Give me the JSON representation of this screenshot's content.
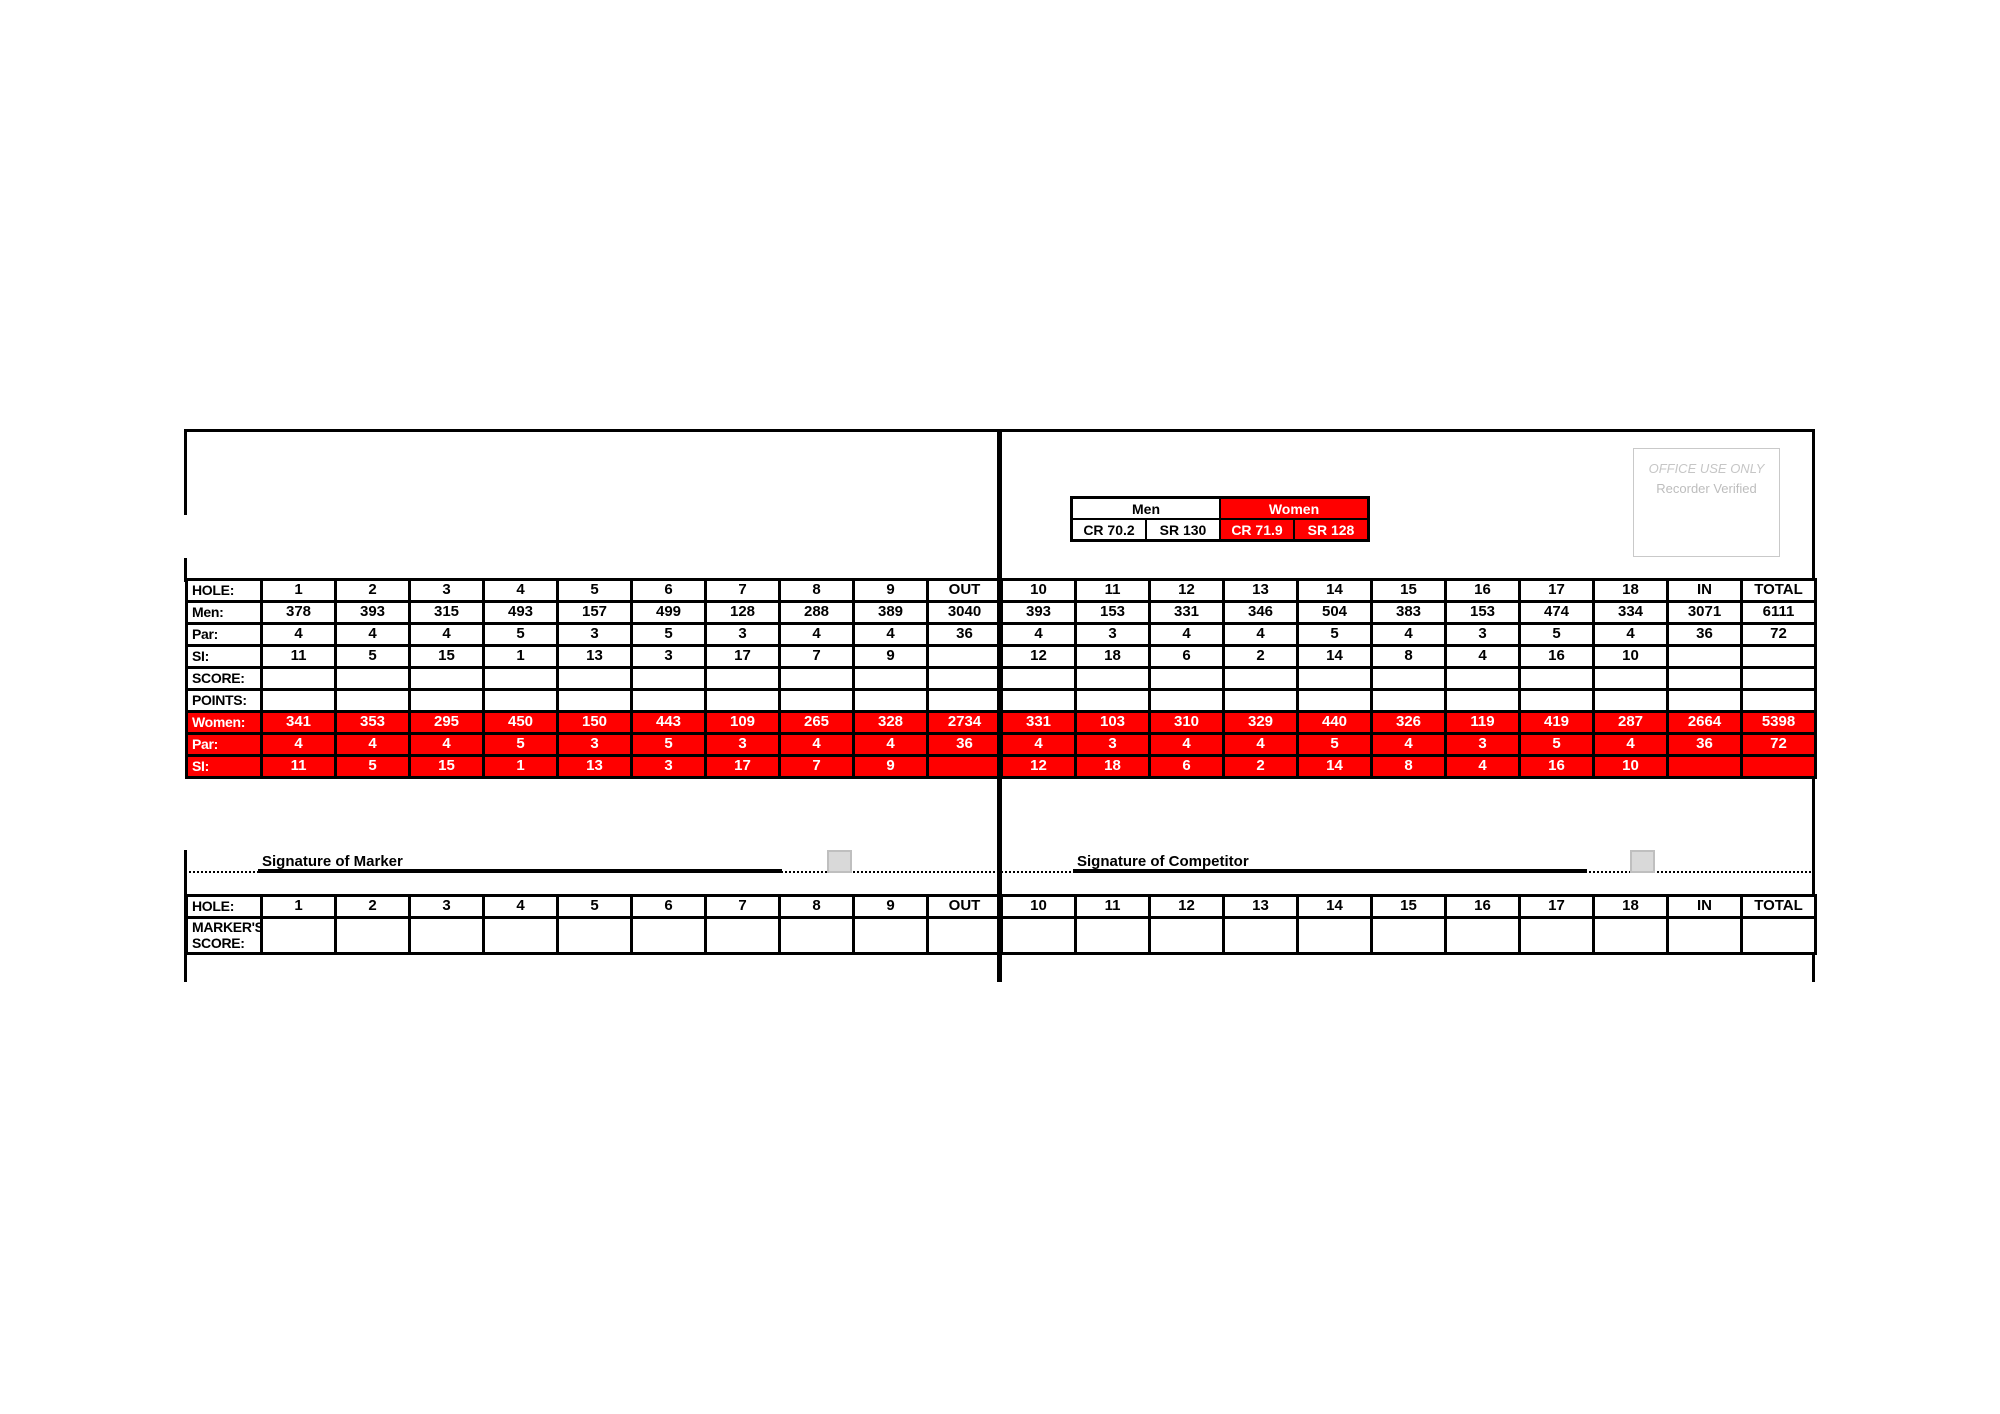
{
  "colors": {
    "accent_red": "#FF0000",
    "border_black": "#000000",
    "checkbox_fill": "#D9D9D9",
    "checkbox_border": "#BFBFBF",
    "office_text_gray": "#C6C6C6"
  },
  "rating_box": {
    "men_label": "Men",
    "women_label": "Women",
    "men_cr": "CR 70.2",
    "men_sr": "SR 130",
    "women_cr": "CR 71.9",
    "women_sr": "SR 128"
  },
  "office_box": {
    "title": "OFFICE USE ONLY",
    "subtitle": "Recorder Verified"
  },
  "course_table": {
    "rows": [
      {
        "label": "HOLE:",
        "variant": "white",
        "cells": [
          "1",
          "2",
          "3",
          "4",
          "5",
          "6",
          "7",
          "8",
          "9",
          "OUT",
          "10",
          "11",
          "12",
          "13",
          "14",
          "15",
          "16",
          "17",
          "18",
          "IN",
          "TOTAL"
        ]
      },
      {
        "label": "Men:",
        "variant": "white",
        "cells": [
          "378",
          "393",
          "315",
          "493",
          "157",
          "499",
          "128",
          "288",
          "389",
          "3040",
          "393",
          "153",
          "331",
          "346",
          "504",
          "383",
          "153",
          "474",
          "334",
          "3071",
          "6111"
        ]
      },
      {
        "label": "Par:",
        "variant": "white",
        "cells": [
          "4",
          "4",
          "4",
          "5",
          "3",
          "5",
          "3",
          "4",
          "4",
          "36",
          "4",
          "3",
          "4",
          "4",
          "5",
          "4",
          "3",
          "5",
          "4",
          "36",
          "72"
        ]
      },
      {
        "label": "SI:",
        "variant": "white",
        "cells": [
          "11",
          "5",
          "15",
          "1",
          "13",
          "3",
          "17",
          "7",
          "9",
          "",
          "12",
          "18",
          "6",
          "2",
          "14",
          "8",
          "4",
          "16",
          "10",
          "",
          ""
        ]
      },
      {
        "label": "SCORE:",
        "variant": "white",
        "cells": [
          "",
          "",
          "",
          "",
          "",
          "",
          "",
          "",
          "",
          "",
          "",
          "",
          "",
          "",
          "",
          "",
          "",
          "",
          "",
          "",
          ""
        ]
      },
      {
        "label": "POINTS:",
        "variant": "white",
        "cells": [
          "",
          "",
          "",
          "",
          "",
          "",
          "",
          "",
          "",
          "",
          "",
          "",
          "",
          "",
          "",
          "",
          "",
          "",
          "",
          "",
          ""
        ]
      },
      {
        "label": "Women:",
        "variant": "red",
        "cells": [
          "341",
          "353",
          "295",
          "450",
          "150",
          "443",
          "109",
          "265",
          "328",
          "2734",
          "331",
          "103",
          "310",
          "329",
          "440",
          "326",
          "119",
          "419",
          "287",
          "2664",
          "5398"
        ]
      },
      {
        "label": "Par:",
        "variant": "red",
        "cells": [
          "4",
          "4",
          "4",
          "5",
          "3",
          "5",
          "3",
          "4",
          "4",
          "36",
          "4",
          "3",
          "4",
          "4",
          "5",
          "4",
          "3",
          "5",
          "4",
          "36",
          "72"
        ]
      },
      {
        "label": "SI:",
        "variant": "red",
        "cells": [
          "11",
          "5",
          "15",
          "1",
          "13",
          "3",
          "17",
          "7",
          "9",
          "",
          "12",
          "18",
          "6",
          "2",
          "14",
          "8",
          "4",
          "16",
          "10",
          "",
          ""
        ]
      }
    ]
  },
  "signatures": {
    "marker_label": "Signature of Marker",
    "competitor_label": "Signature of Competitor"
  },
  "marker_table": {
    "rows": [
      {
        "label": "HOLE:",
        "variant": "white",
        "cells": [
          "1",
          "2",
          "3",
          "4",
          "5",
          "6",
          "7",
          "8",
          "9",
          "OUT",
          "10",
          "11",
          "12",
          "13",
          "14",
          "15",
          "16",
          "17",
          "18",
          "IN",
          "TOTAL"
        ]
      },
      {
        "label": "MARKER'S\nSCORE:",
        "variant": "white",
        "cells": [
          "",
          "",
          "",
          "",
          "",
          "",
          "",
          "",
          "",
          "",
          "",
          "",
          "",
          "",
          "",
          "",
          "",
          "",
          "",
          "",
          ""
        ]
      }
    ]
  }
}
